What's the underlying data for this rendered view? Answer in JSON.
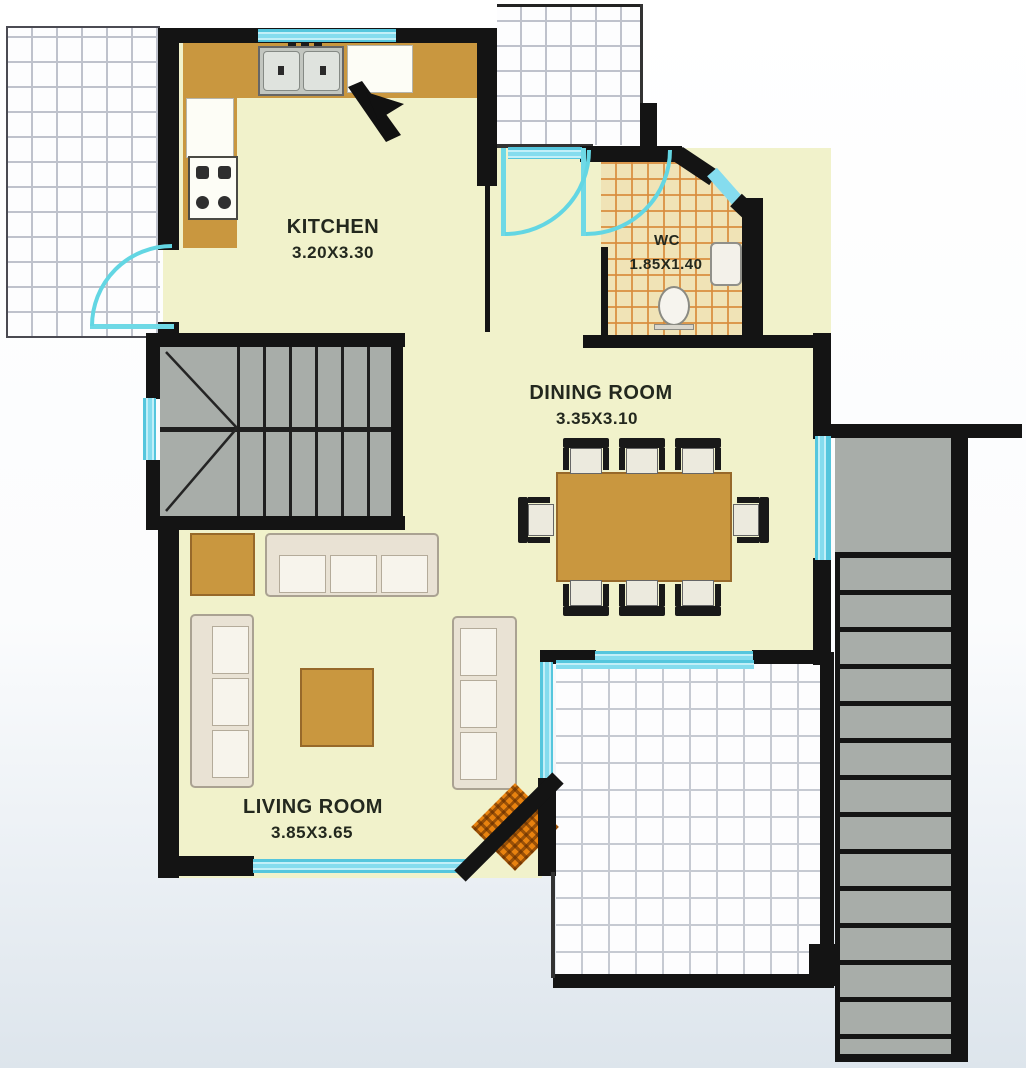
{
  "plan": {
    "title": "floor-plan",
    "rooms": [
      {
        "name": "KITCHEN",
        "dims": "3.20X3.30"
      },
      {
        "name": "WC",
        "dims": "1.85X1.40"
      },
      {
        "name": "DINING ROOM",
        "dims": "3.35X3.10"
      },
      {
        "name": "LIVING ROOM",
        "dims": "3.85X3.65"
      }
    ],
    "colors": {
      "wall": "#141414",
      "floor": "#f1f2cb",
      "counter_tan": "#c9973f",
      "stair_gray": "#a8ada9",
      "window_cyan": "#85dcee",
      "door_arc": "#63d6e3",
      "wc_tile": "#f0e3b6",
      "wc_grid": "#d88c3c",
      "terrace_tile": "#fdfdfe",
      "fireplace_orange": "#e8820f",
      "sofa_cream": "#e9e2d4",
      "label_text": "#23281e"
    },
    "fixtures": [
      "double-sink-icon",
      "stove-icon",
      "counter-icon",
      "entry-door-icon",
      "wc-door-icon",
      "kitchen-door-icon",
      "toilet-icon",
      "wash-basin-icon",
      "dining-table-icon",
      "dining-chair-icon",
      "sofa-icon",
      "coffee-table-icon",
      "side-table-icon",
      "u-stair-icon",
      "external-stair-icon",
      "fireplace-icon",
      "window-icon",
      "terrace-tiles-icon"
    ]
  }
}
